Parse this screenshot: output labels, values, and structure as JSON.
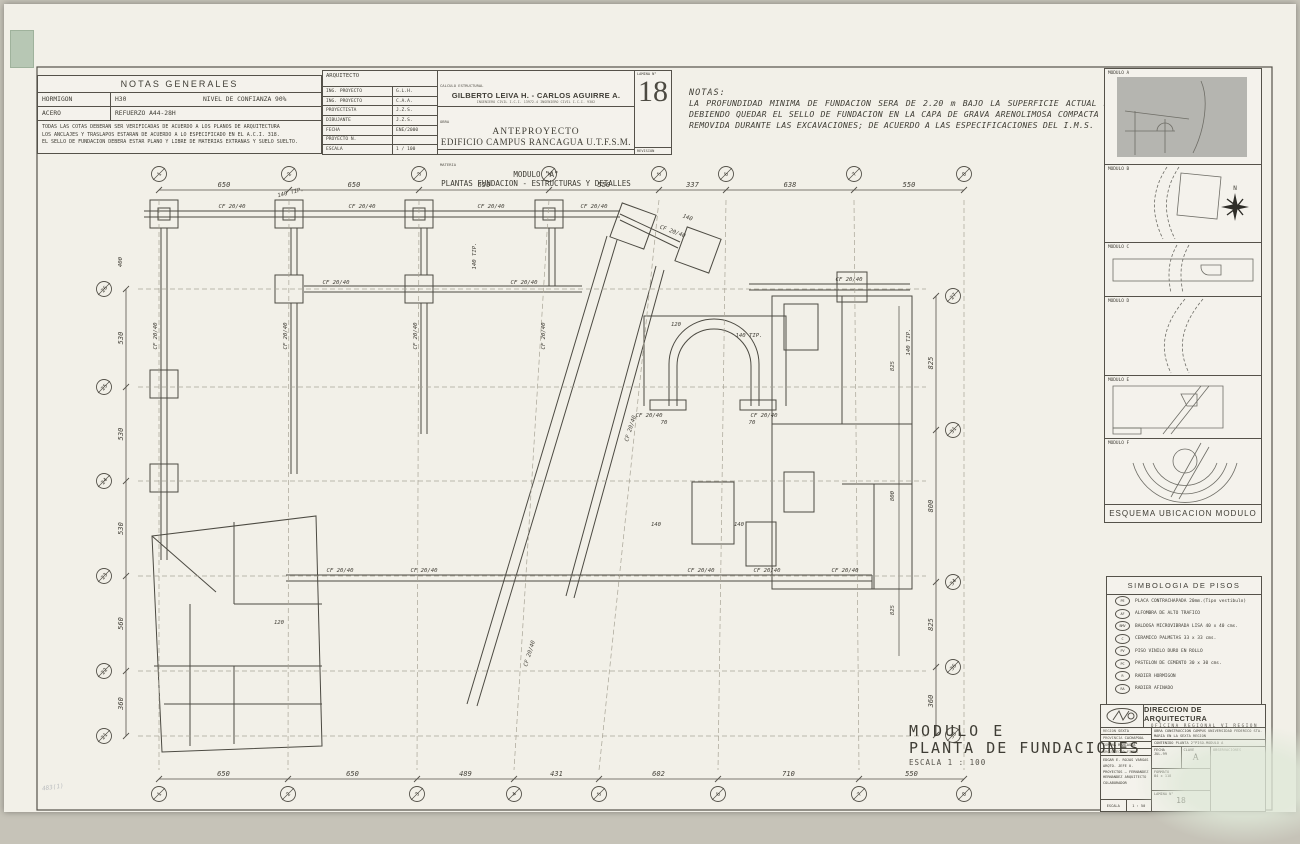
{
  "sheet": {
    "paper": "#f2f0e8",
    "line": "#4c4a42",
    "shade": "#b5b5b0"
  },
  "notas_generales": {
    "title": "NOTAS GENERALES",
    "rows": [
      {
        "c1": "HORMIGON",
        "c2": "H30",
        "c3": "NIVEL DE CONFIANZA 90%"
      },
      {
        "c1": "ACERO",
        "c2": "REFUERZO  A44-28H",
        "c3": ""
      }
    ],
    "notes": [
      "TODAS LAS COTAS DEBERAN SER VERIFICADAS DE ACUERDO A LOS PLANOS DE ARQUITECTURA",
      "LOS ANCLAJES Y TRASLAPOS ESTARAN DE ACUERDO A LO ESPECIFICADO EN EL A.C.I. 318.",
      "EL SELLO DE FUNDACION DEBERA ESTAR PLANO Y LIBRE DE MATERIAS EXTRANAS Y SUELO SUELTO."
    ]
  },
  "title_block": {
    "arquitecto_label": "ARQUITECTO",
    "fields": [
      {
        "label": "ING. PROYECTO",
        "value": "G.L.H."
      },
      {
        "label": "ING. PROYECTO",
        "value": "C.A.A."
      },
      {
        "label": "PROYECTISTA",
        "value": "J.Z.S."
      },
      {
        "label": "DIBUJANTE",
        "value": "J.Z.S."
      },
      {
        "label": "FECHA",
        "value": "ENE/2000"
      },
      {
        "label": "PROYECTO N.",
        "value": ""
      },
      {
        "label": "ESCALA",
        "value": "1 / 100"
      }
    ],
    "calculo_label": "CALCULO ESTRUCTURAL",
    "calculo_names": "GILBERTO LEIVA H.  -  CARLOS AGUIRRE A.",
    "calculo_sub": "INGENIERO CIVIL  I.C.I. 13972-4          INGENIERO CIVIL  I.C.I. 9302",
    "obra_label": "OBRA",
    "obra_line1": "ANTEPROYECTO",
    "obra_line2": "EDIFICIO  CAMPUS  RANCAGUA  U.T.F.S.M.",
    "materia_label": "MATERIA",
    "materia_line1": "MODULO  \"A\"",
    "materia_line2": "PLANTAS FUNDACION - ESTRUCTURAS Y DETALLES",
    "lamina_label": "LAMINA N°",
    "lamina_number": "18",
    "revision_label": "REVISION"
  },
  "notas": {
    "title": "NOTAS:",
    "body": "LA PROFUNDIDAD MINIMA DE FUNDACION SERA DE 2.20 m BAJO LA SUPERFICIE ACTUAL DE TERENO, DEBIENDO QUEDAR EL SELLO DE FUNDACION EN LA CAPA DE GRAVA ARENOLIMOSA COMPACTA ALUVIAL NO REMOVIDA DURANTE LAS EXCAVACIONES; DE ACUERDO A LAS ESPECIFICACIONES DEL I.M.S."
  },
  "esquema": {
    "panels": [
      "MODULO A",
      "MODULO B",
      "MODULO C",
      "MODULO D",
      "MODULO E",
      "MODULO F"
    ],
    "caption": "ESQUEMA UBICACION MODULO",
    "north_label": "N"
  },
  "simbologia": {
    "title": "SIMBOLOGIA DE PISOS",
    "items": [
      {
        "code": "PE",
        "label": "PLACA CONTRACHAPADA 20mm.(Tipo vestibulo)"
      },
      {
        "code": "AF",
        "label": "ALFOMBRA DE ALTO TRAFICO"
      },
      {
        "code": "BMV",
        "label": "BALDOSA MICROVIBRADA LISA 40 x 40 cms."
      },
      {
        "code": "C",
        "label": "CERAMICO PALMETAS 33 x 33 cms."
      },
      {
        "code": "PV",
        "label": "PISO VINILO DURO EN ROLLO"
      },
      {
        "code": "PC",
        "label": "PASTELON DE CEMENTO 30 x 30 cms."
      },
      {
        "code": "R",
        "label": "RADIER HORMIGON"
      },
      {
        "code": "RA",
        "label": "RADIER AFINADO"
      }
    ]
  },
  "mop_block": {
    "logo": "MOP",
    "title": "DIRECCION DE ARQUITECTURA",
    "subtitle": "OFICINA   REGIONAL   VI   REGION",
    "left_fields": [
      {
        "k": "REGION",
        "v": "SEXTA"
      },
      {
        "k": "PROVINCIA",
        "v": "CACHAPOAL"
      },
      {
        "k": "COMUNA",
        "v": "RANCAGUA"
      },
      {
        "k": "ARQUITECTO FIRMA",
        "v": ""
      }
    ],
    "signatures": "EDGAR E. ROJAS VARGAS  ARQTO. JEFE U. PROYECTOS — FERNANDEZ HERNANDEZ  ARQUITECTO COLABORADOR",
    "escala_label": "ESCALA",
    "escala": "1 : 50",
    "firma_label": "FIRMA",
    "obra_label": "OBRA",
    "obra": "CONSTRUCCION CAMPUS UNIVERSIDAD FEDERICO STA. MARIA EN LA SEXTA REGION",
    "contenido_label": "CONTENIDO",
    "contenido": "PLANTA 2°PISO-MODULO A",
    "fecha_label": "FECHA",
    "fecha": "JUL-99",
    "clave_label": "CLAVE",
    "clave": "A",
    "formato_label": "FORMATO",
    "formato": "84 x 118",
    "lamina_label": "LAMINA N°",
    "lamina": "18",
    "observaciones_label": "OBSERVACIONES"
  },
  "plan_title": {
    "line1": "MODULO  E",
    "line2": "PLANTA  DE  FUNDACIONES",
    "scale": "ESCALA 1 : 100"
  },
  "pencil_note": "483(1)",
  "drawing": {
    "dims_top": [
      "650",
      "650",
      "650",
      "550",
      "337",
      "638",
      "550"
    ],
    "dims_bottom": [
      "650",
      "650",
      "489",
      "431",
      "602",
      "710",
      "550"
    ],
    "dims_left": [
      "530",
      "530",
      "530",
      "560",
      "360"
    ],
    "dims_right": [
      "825",
      "800",
      "825",
      "360"
    ],
    "grid_top": [
      "1",
      "2",
      "3",
      "4",
      "5",
      "6",
      "7",
      "8"
    ],
    "grid_bottom": [
      "1",
      "2",
      "3",
      "4",
      "5",
      "6",
      "7",
      "8"
    ],
    "grid_left": [
      "26",
      "25",
      "24",
      "23",
      "22",
      "21"
    ],
    "grid_right": [
      "27",
      "31",
      "34",
      "36",
      "38"
    ],
    "beam_label": "CF 20/40",
    "misc_labels": [
      "140 TIP.",
      "140 TIP.",
      "140",
      "140 TIP.",
      "120",
      "70",
      "70",
      "825",
      "800",
      "825",
      "400",
      "140 TIP.",
      "140",
      "140",
      "120"
    ]
  }
}
